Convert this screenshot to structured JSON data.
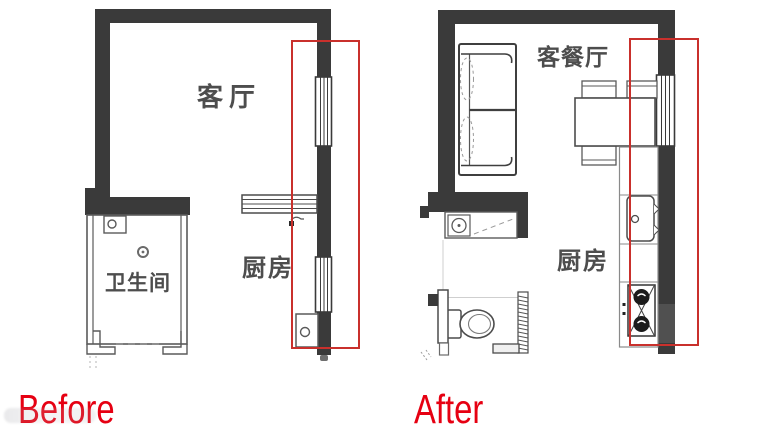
{
  "canvas": {
    "width": 760,
    "height": 436,
    "background": "#ffffff"
  },
  "colors": {
    "wall": "#3a3a3a",
    "wall_light": "#505050",
    "outline": "#4c4c4c",
    "highlight_box": "#c9302c",
    "caption_red": "#e60012",
    "room_label": "#4d4d4d"
  },
  "before_plan": {
    "title": "Before",
    "rooms": {
      "living_room": "客厅",
      "bathroom": "卫生间",
      "kitchen": "厨房"
    }
  },
  "after_plan": {
    "title": "After",
    "rooms": {
      "living_dining_room": "客餐厅",
      "kitchen": "厨房"
    }
  }
}
